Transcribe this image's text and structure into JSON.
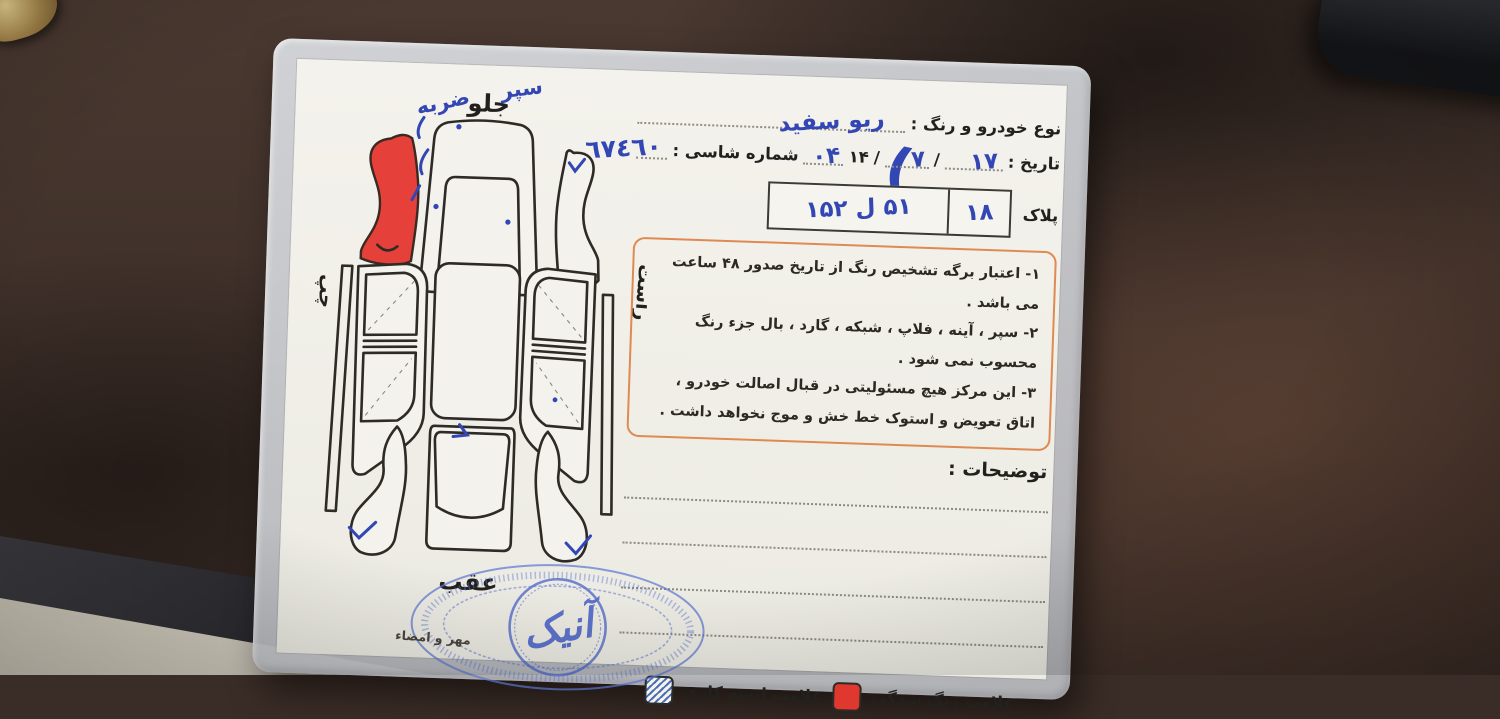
{
  "card": {
    "header": {
      "vehicle_label": "نوع خودرو و رنگ :",
      "vehicle_value": "ریو سفید",
      "date_label": "تاریخ :",
      "date_day": "۱۷",
      "date_month": "۷",
      "date_year_prefix": "۱۴",
      "date_year_suffix": "۰۴",
      "chassis_label": "شماره شاسی :",
      "chassis_value": "٦٧٤٦٠",
      "plate_label": "پلاک",
      "plate_value": "۵۱ ل ۱۵۲",
      "plate_region": "۱۸",
      "separator": "/"
    },
    "disclaimer": {
      "lines": [
        "۱- اعتبار برگه تشخیص رنگ از تاریخ صدور ۴۸ ساعت می باشد .",
        "۲- سپر ، آینه ، فلاپ ، شبکه ، گارد ، بال جزء رنگ محسوب نمی شود .",
        "۳- این مرکز هیچ مسئولیتی در قبال اصالت خودرو ، اتاق تعویض و استوک خط خش و موج نخواهد داشت ."
      ]
    },
    "notes": {
      "label": "توضیحات :"
    },
    "legend": {
      "paint_label": "علامت رنگ شدگی",
      "scrape_label": "علامت لیسه کاری"
    },
    "diagram": {
      "front_label": "جلو",
      "rear_label": "عقب",
      "left_label": "چپ",
      "right_label": "راست",
      "annotation_bumper": "سپر",
      "annotation_dent": "ضربه",
      "flourish": "("
    },
    "stamp": {
      "text": "آنیک"
    },
    "signature_label": "مهر و امضاء",
    "colors": {
      "damage_red": "#e0372e",
      "hand_blue": "#3246b4",
      "stamp_blue": "#4a63c8",
      "box_orange": "#df8a52"
    }
  }
}
